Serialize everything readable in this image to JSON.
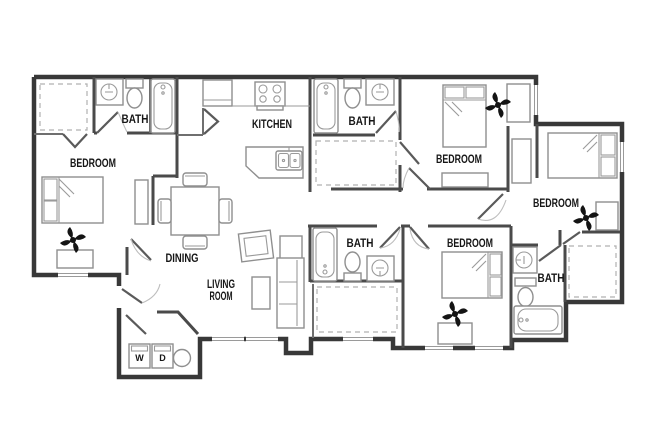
{
  "title": "apartment floor plan",
  "colors": {
    "background": "#ffffff",
    "exterior_wall": "#383838",
    "interior_wall": "#4a4a4a",
    "fixture_line": "#8f8f8f",
    "closet_dash": "#b0b0b0",
    "label_text": "#161616"
  },
  "icons": {
    "ceiling_fan": "black pinwheel glyph",
    "water_heater": "plain circle",
    "sink": "circle in cabinet square",
    "stove": "four burner circles",
    "door_swing": "diagonal leaf with thin arc"
  },
  "labels": {
    "bedroom_top_left": "BEDROOM",
    "bath_top_left": "BATH",
    "kitchen": "KITCHEN",
    "bath_top_middle": "BATH",
    "bedroom_top_right": "BEDROOM",
    "bedroom_right": "BEDROOM",
    "dining": "DINING",
    "living_line1": "LIVING",
    "living_line2": "ROOM",
    "bath_bottom_middle": "BATH",
    "bedroom_bottom": "BEDROOM",
    "bath_bottom_right": "BATH",
    "washer": "W",
    "dryer": "D"
  }
}
